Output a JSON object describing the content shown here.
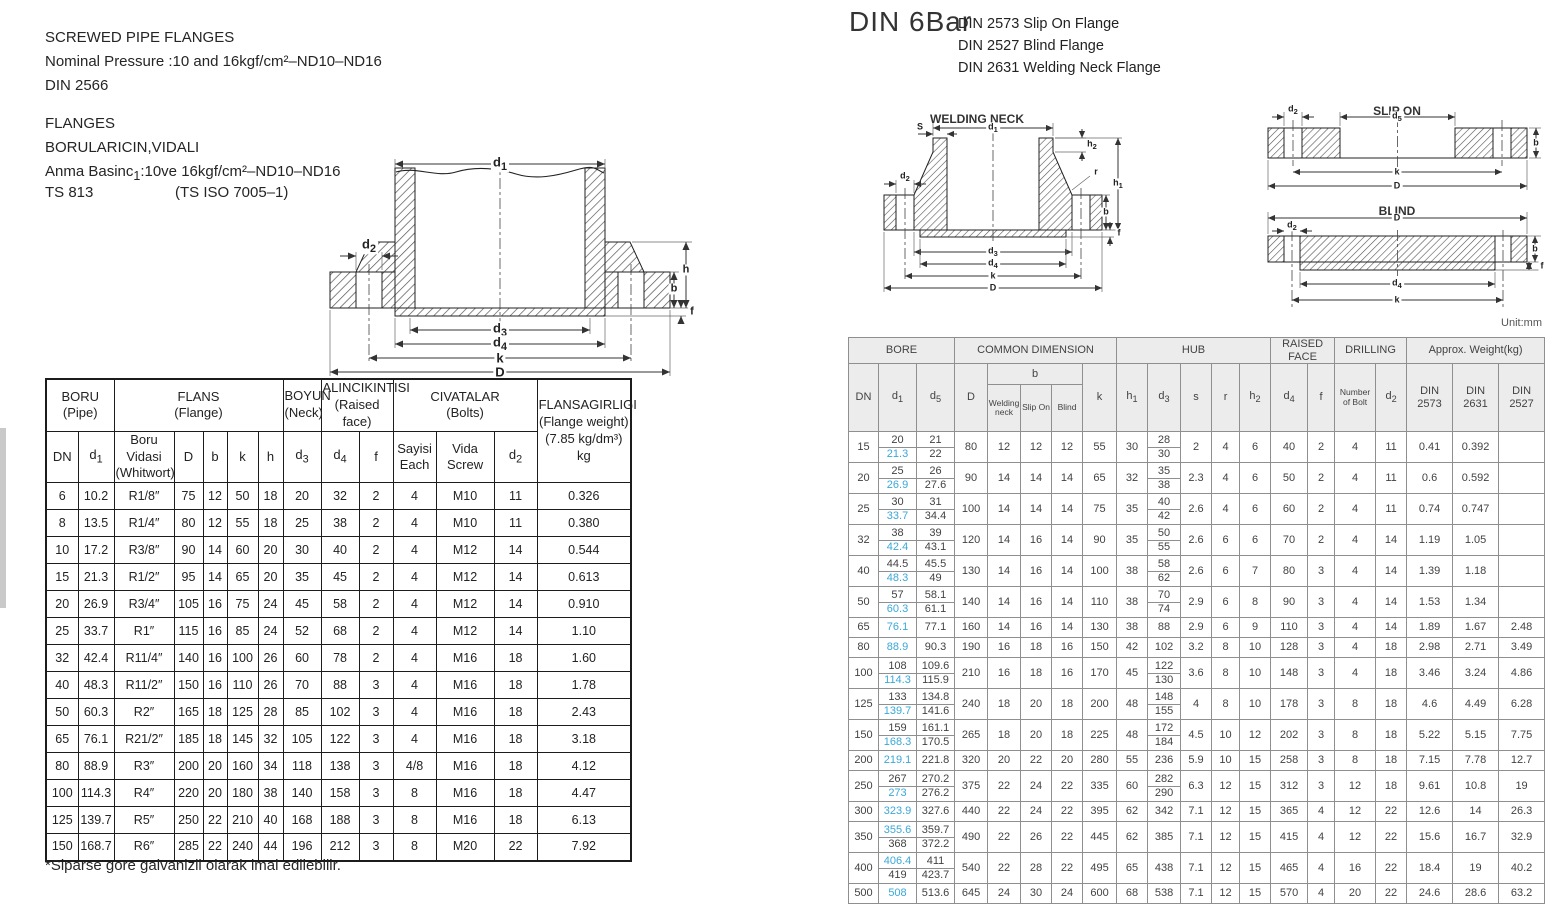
{
  "colors": {
    "highlight": "#3aa8d8"
  },
  "left": {
    "heading": [
      "SCREWED PIPE FLANGES",
      "Nominal Pressure :10 and 16kgf/cm²–ND10–ND16",
      "DIN 2566"
    ],
    "subheading": [
      "FLANGES",
      "BORULARICIN,VIDALI",
      "Anma Basinc_1:10ve 16kgf/cm²–ND10–ND16"
    ],
    "ts_code": "TS 813",
    "ts_iso": "(TS ISO 7005–1)",
    "footnote": "*Siparse gore galvanizli olarak imal edilebilir.",
    "drawing_labels": {
      "d1": "d_1",
      "d2": "d_2",
      "d3": "d_3",
      "d4": "d_4",
      "k": "k",
      "D": "D",
      "b": "b",
      "h": "h",
      "f": "f"
    },
    "table": {
      "groups": [
        [
          "BORU\n(Pipe)",
          2,
          ""
        ],
        [
          "FLANS\n(Flange)",
          5,
          ""
        ],
        [
          "BOYUN\n(Neck)",
          1,
          "sm"
        ],
        [
          "ALINCIKINTISI\n(Raised face)",
          2,
          "sm"
        ],
        [
          "CIVATALAR\n(Bolts)",
          3,
          ""
        ]
      ],
      "weight_header": "FLANSAGIRLIGI\n(Flange weight)\n(7.85 kg/dm³)\nkg",
      "subheaders": [
        [
          "DN",
          ""
        ],
        [
          "d_1",
          ""
        ],
        [
          "Boru Vidasi\n(Whitwort)",
          "sm"
        ],
        [
          "D",
          ""
        ],
        [
          "b",
          ""
        ],
        [
          "k",
          ""
        ],
        [
          "h",
          ""
        ],
        [
          "d_3",
          ""
        ],
        [
          "d_4",
          ""
        ],
        [
          "f",
          ""
        ],
        [
          "Sayisi\nEach",
          ""
        ],
        [
          "Vida\nScrew",
          ""
        ],
        [
          "d_2",
          ""
        ]
      ],
      "rows": [
        [
          "6",
          "10.2",
          "R1/8″",
          "75",
          "12",
          "50",
          "18",
          "20",
          "32",
          "2",
          "4",
          "M10",
          "11",
          "0.326"
        ],
        [
          "8",
          "13.5",
          "R1/4″",
          "80",
          "12",
          "55",
          "18",
          "25",
          "38",
          "2",
          "4",
          "M10",
          "11",
          "0.380"
        ],
        [
          "10",
          "17.2",
          "R3/8″",
          "90",
          "14",
          "60",
          "20",
          "30",
          "40",
          "2",
          "4",
          "M12",
          "14",
          "0.544"
        ],
        [
          "15",
          "21.3",
          "R1/2″",
          "95",
          "14",
          "65",
          "20",
          "35",
          "45",
          "2",
          "4",
          "M12",
          "14",
          "0.613"
        ],
        [
          "20",
          "26.9",
          "R3/4″",
          "105",
          "16",
          "75",
          "24",
          "45",
          "58",
          "2",
          "4",
          "M12",
          "14",
          "0.910"
        ],
        [
          "25",
          "33.7",
          "R1″",
          "115",
          "16",
          "85",
          "24",
          "52",
          "68",
          "2",
          "4",
          "M12",
          "14",
          "1.10"
        ],
        [
          "32",
          "42.4",
          "R11/4″",
          "140",
          "16",
          "100",
          "26",
          "60",
          "78",
          "2",
          "4",
          "M16",
          "18",
          "1.60"
        ],
        [
          "40",
          "48.3",
          "R11/2″",
          "150",
          "16",
          "110",
          "26",
          "70",
          "88",
          "3",
          "4",
          "M16",
          "18",
          "1.78"
        ],
        [
          "50",
          "60.3",
          "R2″",
          "165",
          "18",
          "125",
          "28",
          "85",
          "102",
          "3",
          "4",
          "M16",
          "18",
          "2.43"
        ],
        [
          "65",
          "76.1",
          "R21/2″",
          "185",
          "18",
          "145",
          "32",
          "105",
          "122",
          "3",
          "4",
          "M16",
          "18",
          "3.18"
        ],
        [
          "80",
          "88.9",
          "R3″",
          "200",
          "20",
          "160",
          "34",
          "118",
          "138",
          "3",
          "4/8",
          "M16",
          "18",
          "4.12"
        ],
        [
          "100",
          "114.3",
          "R4″",
          "220",
          "20",
          "180",
          "38",
          "140",
          "158",
          "3",
          "8",
          "M16",
          "18",
          "4.47"
        ],
        [
          "125",
          "139.7",
          "R5″",
          "250",
          "22",
          "210",
          "40",
          "168",
          "188",
          "3",
          "8",
          "M16",
          "18",
          "6.13"
        ],
        [
          "150",
          "168.7",
          "R6″",
          "285",
          "22",
          "240",
          "44",
          "196",
          "212",
          "3",
          "8",
          "M20",
          "22",
          "7.92"
        ]
      ]
    }
  },
  "right": {
    "title": "DIN 6Bar",
    "subtitle": [
      "DIN 2573 Slip On Flange",
      "DIN 2527 Blind Flange",
      "DIN 2631 Welding Neck Flange"
    ],
    "unit": "Unit:mm",
    "drawings": {
      "welding_neck": {
        "title": "WELDING NECK",
        "labels": {
          "d1": "d_1",
          "S": "S",
          "h2": "h_2",
          "d2": "d_2",
          "r": "r",
          "h1": "h_1",
          "b": "b",
          "f": "f",
          "d3": "d_3",
          "d4": "d_4",
          "k": "k",
          "D": "D"
        }
      },
      "slip_on": {
        "title": "SLIP ON",
        "labels": {
          "d2": "d_2",
          "d5": "d_5",
          "b": "b",
          "k": "k",
          "D": "D"
        }
      },
      "blind": {
        "title": "BLIND",
        "labels": {
          "D": "D",
          "d2": "d_2",
          "b": "b",
          "f": "f",
          "d4": "d_4",
          "k": "k"
        }
      }
    },
    "table": {
      "groups": [
        [
          "BORE",
          3
        ],
        [
          "COMMON DIMENSION",
          5
        ],
        [
          "HUB",
          5
        ],
        [
          "RAISED FACE",
          2
        ],
        [
          "DRILLING",
          2
        ],
        [
          "Approx. Weight(kg)",
          3
        ]
      ],
      "head2": [
        [
          "DN",
          1,
          ""
        ],
        [
          "d_1",
          1,
          ""
        ],
        [
          "d_5",
          1,
          ""
        ],
        [
          "D",
          1,
          ""
        ],
        [
          "b",
          3,
          ""
        ],
        [
          "k",
          1,
          ""
        ],
        [
          "h_1",
          1,
          ""
        ],
        [
          "d_3",
          1,
          ""
        ],
        [
          "s",
          1,
          ""
        ],
        [
          "r",
          1,
          ""
        ],
        [
          "h_2",
          1,
          ""
        ],
        [
          "d_4",
          1,
          ""
        ],
        [
          "f",
          1,
          ""
        ],
        [
          "Number\nof Bolt",
          1,
          "xs"
        ],
        [
          "d_2",
          1,
          ""
        ],
        [
          "DIN\n2573",
          1,
          ""
        ],
        [
          "DIN\n2631",
          1,
          ""
        ],
        [
          "DIN\n2527",
          1,
          ""
        ]
      ],
      "head3": [
        [
          "Welding\nneck",
          "xs"
        ],
        [
          "Slip On",
          "xs"
        ],
        [
          "Blind",
          "xs"
        ]
      ],
      "rows": [
        [
          "15",
          [
            "20",
            "*21.3"
          ],
          [
            "21",
            "22"
          ],
          "80",
          "12",
          "12",
          "12",
          "55",
          "30",
          [
            "28",
            "30"
          ],
          "2",
          "4",
          "6",
          "40",
          "2",
          "4",
          "11",
          "0.41",
          "0.392",
          ""
        ],
        [
          "20",
          [
            "25",
            "*26.9"
          ],
          [
            "26",
            "27.6"
          ],
          "90",
          "14",
          "14",
          "14",
          "65",
          "32",
          [
            "35",
            "38"
          ],
          "2.3",
          "4",
          "6",
          "50",
          "2",
          "4",
          "11",
          "0.6",
          "0.592",
          ""
        ],
        [
          "25",
          [
            "30",
            "*33.7"
          ],
          [
            "31",
            "34.4"
          ],
          "100",
          "14",
          "14",
          "14",
          "75",
          "35",
          [
            "40",
            "42"
          ],
          "2.6",
          "4",
          "6",
          "60",
          "2",
          "4",
          "11",
          "0.74",
          "0.747",
          ""
        ],
        [
          "32",
          [
            "38",
            "*42.4"
          ],
          [
            "39",
            "43.1"
          ],
          "120",
          "14",
          "16",
          "14",
          "90",
          "35",
          [
            "50",
            "55"
          ],
          "2.6",
          "6",
          "6",
          "70",
          "2",
          "4",
          "14",
          "1.19",
          "1.05",
          ""
        ],
        [
          "40",
          [
            "44.5",
            "*48.3"
          ],
          [
            "45.5",
            "49"
          ],
          "130",
          "14",
          "16",
          "14",
          "100",
          "38",
          [
            "58",
            "62"
          ],
          "2.6",
          "6",
          "7",
          "80",
          "3",
          "4",
          "14",
          "1.39",
          "1.18",
          ""
        ],
        [
          "50",
          [
            "57",
            "*60.3"
          ],
          [
            "58.1",
            "61.1"
          ],
          "140",
          "14",
          "16",
          "14",
          "110",
          "38",
          [
            "70",
            "74"
          ],
          "2.9",
          "6",
          "8",
          "90",
          "3",
          "4",
          "14",
          "1.53",
          "1.34",
          ""
        ],
        [
          "65",
          "*76.1",
          "77.1",
          "160",
          "14",
          "16",
          "14",
          "130",
          "38",
          "88",
          "2.9",
          "6",
          "9",
          "110",
          "3",
          "4",
          "14",
          "1.89",
          "1.67",
          "2.48"
        ],
        [
          "80",
          "*88.9",
          "90.3",
          "190",
          "16",
          "18",
          "16",
          "150",
          "42",
          "102",
          "3.2",
          "8",
          "10",
          "128",
          "3",
          "4",
          "18",
          "2.98",
          "2.71",
          "3.49"
        ],
        [
          "100",
          [
            "108",
            "*114.3"
          ],
          [
            "109.6",
            "115.9"
          ],
          "210",
          "16",
          "18",
          "16",
          "170",
          "45",
          [
            "122",
            "130"
          ],
          "3.6",
          "8",
          "10",
          "148",
          "3",
          "4",
          "18",
          "3.46",
          "3.24",
          "4.86"
        ],
        [
          "125",
          [
            "133",
            "*139.7"
          ],
          [
            "134.8",
            "141.6"
          ],
          "240",
          "18",
          "20",
          "18",
          "200",
          "48",
          [
            "148",
            "155"
          ],
          "4",
          "8",
          "10",
          "178",
          "3",
          "8",
          "18",
          "4.6",
          "4.49",
          "6.28"
        ],
        [
          "150",
          [
            "159",
            "*168.3"
          ],
          [
            "161.1",
            "170.5"
          ],
          "265",
          "18",
          "20",
          "18",
          "225",
          "48",
          [
            "172",
            "184"
          ],
          "4.5",
          "10",
          "12",
          "202",
          "3",
          "8",
          "18",
          "5.22",
          "5.15",
          "7.75"
        ],
        [
          "200",
          "*219.1",
          "221.8",
          "320",
          "20",
          "22",
          "20",
          "280",
          "55",
          "236",
          "5.9",
          "10",
          "15",
          "258",
          "3",
          "8",
          "18",
          "7.15",
          "7.78",
          "12.7"
        ],
        [
          "250",
          [
            "267",
            "*273"
          ],
          [
            "270.2",
            "276.2"
          ],
          "375",
          "22",
          "24",
          "22",
          "335",
          "60",
          [
            "282",
            "290"
          ],
          "6.3",
          "12",
          "15",
          "312",
          "3",
          "12",
          "18",
          "9.61",
          "10.8",
          "19"
        ],
        [
          "300",
          "*323.9",
          "327.6",
          "440",
          "22",
          "24",
          "22",
          "395",
          "62",
          "342",
          "7.1",
          "12",
          "15",
          "365",
          "4",
          "12",
          "22",
          "12.6",
          "14",
          "26.3"
        ],
        [
          "350",
          [
            "*355.6",
            "368"
          ],
          [
            "359.7",
            "372.2"
          ],
          "490",
          "22",
          "26",
          "22",
          "445",
          "62",
          "385",
          "7.1",
          "12",
          "15",
          "415",
          "4",
          "12",
          "22",
          "15.6",
          "16.7",
          "32.9"
        ],
        [
          "400",
          [
            "*406.4",
            "419"
          ],
          [
            "411",
            "423.7"
          ],
          "540",
          "22",
          "28",
          "22",
          "495",
          "65",
          "438",
          "7.1",
          "12",
          "15",
          "465",
          "4",
          "16",
          "22",
          "18.4",
          "19",
          "40.2"
        ],
        [
          "500",
          "*508",
          "513.6",
          "645",
          "24",
          "30",
          "24",
          "600",
          "68",
          "538",
          "7.1",
          "12",
          "15",
          "570",
          "4",
          "20",
          "22",
          "24.6",
          "28.6",
          "63.2"
        ]
      ]
    }
  }
}
